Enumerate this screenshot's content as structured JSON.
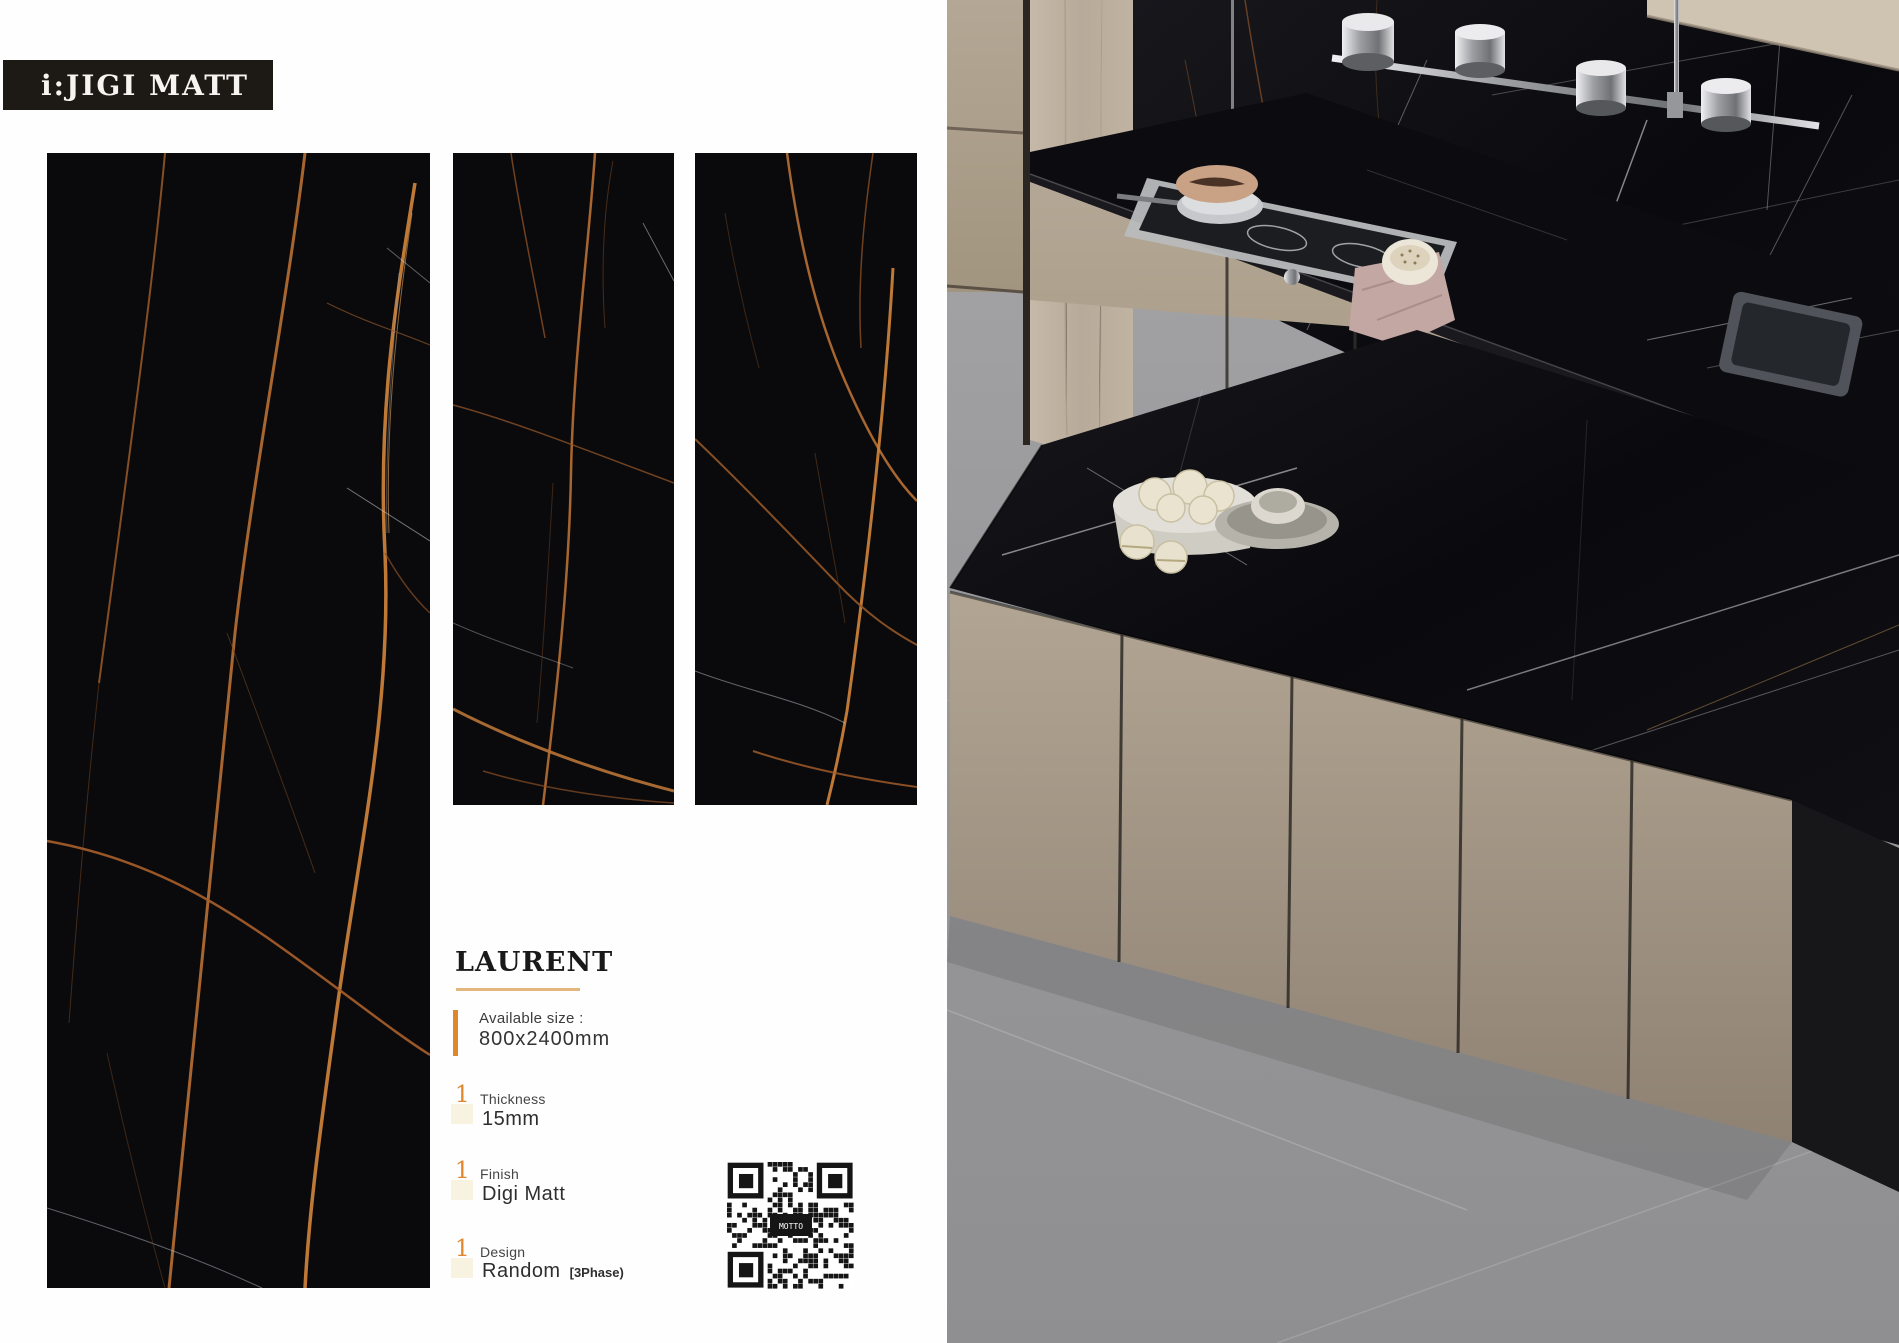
{
  "header": {
    "badge_label": "i:JIGI MATT",
    "badge_bg": "#1d1a16",
    "badge_text_color": "#f6f4f0"
  },
  "product": {
    "name": "LAURENT",
    "underline_color": "#e2b67c",
    "accent_color": "#e0862c",
    "specs": [
      {
        "label": "Available size :",
        "value": "800x2400mm",
        "marker": "bar"
      },
      {
        "label": "Thickness",
        "value": "15mm",
        "marker": "1"
      },
      {
        "label": "Finish",
        "value": "Digi Matt",
        "marker": "1"
      },
      {
        "label": "Design",
        "value": "Random",
        "value_suffix": "[3Phase)",
        "marker": "1"
      }
    ]
  },
  "qr": {
    "label": "MOTTO"
  },
  "tiles": {
    "count": 3,
    "base_color": "#0a0a0d",
    "vein_gold": "#b06a32",
    "vein_bright": "#c8803a"
  }
}
